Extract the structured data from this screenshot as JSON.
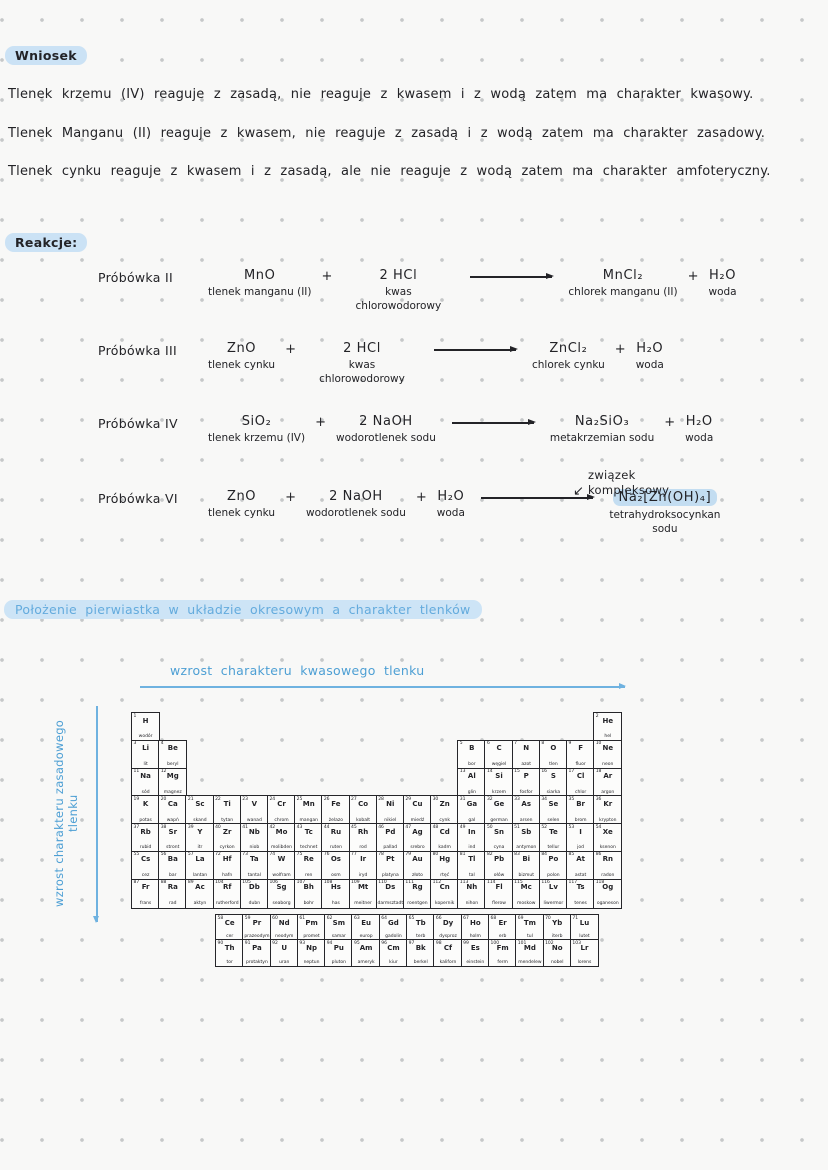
{
  "labels": {
    "wniosek": "Wniosek",
    "reakcje": "Reakcje:",
    "section_heading": "Położenie pierwiastka w układzie okresowym a charakter tlenków",
    "acid_arrow": "wzrost charakteru kwasowego tlenku",
    "base_arrow": "wzrost charakteru zasadowego tlenku",
    "complex_note_line1": "związek",
    "complex_note_line2": "kompleksowy"
  },
  "icons": {
    "complex_arrow": "↙"
  },
  "conclusions": [
    "Tlenek krzemu (IV) reaguje z zasadą, nie reaguje z kwasem i z wodą zatem ma charakter kwasowy.",
    "Tlenek Manganu (II) reaguje z kwasem, nie reaguje z zasadą i z wodą zatem ma charakter zasadowy.",
    "Tlenek cynku reaguje z kwasem i z zasadą, ale nie reaguje z wodą zatem ma charakter amfoteryczny."
  ],
  "reactions": [
    {
      "tube": "Próbówka II",
      "arrow_after": 2,
      "terms": [
        {
          "formula": "MnO",
          "label": "tlenek manganu (II)"
        },
        {
          "formula": "2 HCl",
          "label": "kwas chlorowodorowy"
        },
        {
          "formula": "MnCl₂",
          "label": "chlorek manganu (II)"
        },
        {
          "formula": "H₂O",
          "label": "woda"
        }
      ]
    },
    {
      "tube": "Próbówka III",
      "arrow_after": 2,
      "terms": [
        {
          "formula": "ZnO",
          "label": "tlenek cynku"
        },
        {
          "formula": "2 HCl",
          "label": "kwas chlorowodorowy"
        },
        {
          "formula": "ZnCl₂",
          "label": "chlorek cynku"
        },
        {
          "formula": "H₂O",
          "label": "woda"
        }
      ]
    },
    {
      "tube": "Próbówka IV",
      "arrow_after": 2,
      "terms": [
        {
          "formula": "SiO₂",
          "label": "tlenek krzemu (IV)"
        },
        {
          "formula": "2 NaOH",
          "label": "wodorotlenek sodu"
        },
        {
          "formula": "Na₂SiO₃",
          "label": "metakrzemian sodu"
        },
        {
          "formula": "H₂O",
          "label": "woda"
        }
      ]
    },
    {
      "tube": "Próbówka VI",
      "arrow_after": 3,
      "terms": [
        {
          "formula": "ZnO",
          "label": "tlenek cynku"
        },
        {
          "formula": "2 NaOH",
          "label": "wodorotlenek sodu"
        },
        {
          "formula": "H₂O",
          "label": "woda"
        },
        {
          "formula": "Na₂[Zn(OH)₄]",
          "label": "tetrahydroksocynkan sodu",
          "highlight": true
        }
      ]
    }
  ],
  "colors": {
    "ink": "#232327",
    "blue_ink": "#4d9fd4",
    "label_highlight": "#cbe2f5",
    "heading_highlight": "#cde4f6",
    "product_highlight": "#c3ddf1",
    "arrow_blue": "#6fb2e0",
    "dot_grid": "#c6c8c9",
    "paper": "#f8f8f7"
  },
  "periodic_table": {
    "elements": [
      [
        1,
        "H",
        "wodór",
        1,
        1
      ],
      [
        2,
        "He",
        "hel",
        1,
        18
      ],
      [
        3,
        "Li",
        "lit",
        2,
        1
      ],
      [
        4,
        "Be",
        "beryl",
        2,
        2
      ],
      [
        5,
        "B",
        "bor",
        2,
        13
      ],
      [
        6,
        "C",
        "węgiel",
        2,
        14
      ],
      [
        7,
        "N",
        "azot",
        2,
        15
      ],
      [
        8,
        "O",
        "tlen",
        2,
        16
      ],
      [
        9,
        "F",
        "fluor",
        2,
        17
      ],
      [
        10,
        "Ne",
        "neon",
        2,
        18
      ],
      [
        11,
        "Na",
        "sód",
        3,
        1
      ],
      [
        12,
        "Mg",
        "magnez",
        3,
        2
      ],
      [
        13,
        "Al",
        "glin",
        3,
        13
      ],
      [
        14,
        "Si",
        "krzem",
        3,
        14
      ],
      [
        15,
        "P",
        "fosfor",
        3,
        15
      ],
      [
        16,
        "S",
        "siarka",
        3,
        16
      ],
      [
        17,
        "Cl",
        "chlor",
        3,
        17
      ],
      [
        18,
        "Ar",
        "argon",
        3,
        18
      ],
      [
        19,
        "K",
        "potas",
        4,
        1
      ],
      [
        20,
        "Ca",
        "wapń",
        4,
        2
      ],
      [
        21,
        "Sc",
        "skand",
        4,
        3
      ],
      [
        22,
        "Ti",
        "tytan",
        4,
        4
      ],
      [
        23,
        "V",
        "wanad",
        4,
        5
      ],
      [
        24,
        "Cr",
        "chrom",
        4,
        6
      ],
      [
        25,
        "Mn",
        "mangan",
        4,
        7
      ],
      [
        26,
        "Fe",
        "żelazo",
        4,
        8
      ],
      [
        27,
        "Co",
        "kobalt",
        4,
        9
      ],
      [
        28,
        "Ni",
        "nikiel",
        4,
        10
      ],
      [
        29,
        "Cu",
        "miedź",
        4,
        11
      ],
      [
        30,
        "Zn",
        "cynk",
        4,
        12
      ],
      [
        31,
        "Ga",
        "gal",
        4,
        13
      ],
      [
        32,
        "Ge",
        "german",
        4,
        14
      ],
      [
        33,
        "As",
        "arsen",
        4,
        15
      ],
      [
        34,
        "Se",
        "selen",
        4,
        16
      ],
      [
        35,
        "Br",
        "brom",
        4,
        17
      ],
      [
        36,
        "Kr",
        "krypton",
        4,
        18
      ],
      [
        37,
        "Rb",
        "rubid",
        5,
        1
      ],
      [
        38,
        "Sr",
        "stront",
        5,
        2
      ],
      [
        39,
        "Y",
        "itr",
        5,
        3
      ],
      [
        40,
        "Zr",
        "cyrkon",
        5,
        4
      ],
      [
        41,
        "Nb",
        "niob",
        5,
        5
      ],
      [
        42,
        "Mo",
        "molibden",
        5,
        6
      ],
      [
        43,
        "Tc",
        "technet",
        5,
        7
      ],
      [
        44,
        "Ru",
        "ruten",
        5,
        8
      ],
      [
        45,
        "Rh",
        "rod",
        5,
        9
      ],
      [
        46,
        "Pd",
        "pallad",
        5,
        10
      ],
      [
        47,
        "Ag",
        "srebro",
        5,
        11
      ],
      [
        48,
        "Cd",
        "kadm",
        5,
        12
      ],
      [
        49,
        "In",
        "ind",
        5,
        13
      ],
      [
        50,
        "Sn",
        "cyna",
        5,
        14
      ],
      [
        51,
        "Sb",
        "antymon",
        5,
        15
      ],
      [
        52,
        "Te",
        "tellur",
        5,
        16
      ],
      [
        53,
        "I",
        "jod",
        5,
        17
      ],
      [
        54,
        "Xe",
        "ksenon",
        5,
        18
      ],
      [
        55,
        "Cs",
        "cez",
        6,
        1
      ],
      [
        56,
        "Ba",
        "bar",
        6,
        2
      ],
      [
        57,
        "La",
        "lantan",
        6,
        3
      ],
      [
        72,
        "Hf",
        "hafn",
        6,
        4
      ],
      [
        73,
        "Ta",
        "tantal",
        6,
        5
      ],
      [
        74,
        "W",
        "wolfram",
        6,
        6
      ],
      [
        75,
        "Re",
        "ren",
        6,
        7
      ],
      [
        76,
        "Os",
        "osm",
        6,
        8
      ],
      [
        77,
        "Ir",
        "iryd",
        6,
        9
      ],
      [
        78,
        "Pt",
        "platyna",
        6,
        10
      ],
      [
        79,
        "Au",
        "złoto",
        6,
        11
      ],
      [
        80,
        "Hg",
        "rtęć",
        6,
        12
      ],
      [
        81,
        "Tl",
        "tal",
        6,
        13
      ],
      [
        82,
        "Pb",
        "ołów",
        6,
        14
      ],
      [
        83,
        "Bi",
        "bizmut",
        6,
        15
      ],
      [
        84,
        "Po",
        "polon",
        6,
        16
      ],
      [
        85,
        "At",
        "astat",
        6,
        17
      ],
      [
        86,
        "Rn",
        "radon",
        6,
        18
      ],
      [
        87,
        "Fr",
        "frans",
        7,
        1
      ],
      [
        88,
        "Ra",
        "rad",
        7,
        2
      ],
      [
        89,
        "Ac",
        "aktyn",
        7,
        3
      ],
      [
        104,
        "Rf",
        "rutherford",
        7,
        4
      ],
      [
        105,
        "Db",
        "dubn",
        7,
        5
      ],
      [
        106,
        "Sg",
        "seaborg",
        7,
        6
      ],
      [
        107,
        "Bh",
        "bohr",
        7,
        7
      ],
      [
        108,
        "Hs",
        "has",
        7,
        8
      ],
      [
        109,
        "Mt",
        "meitner",
        7,
        9
      ],
      [
        110,
        "Ds",
        "darmsztadt",
        7,
        10
      ],
      [
        111,
        "Rg",
        "roentgen",
        7,
        11
      ],
      [
        112,
        "Cn",
        "kopernik",
        7,
        12
      ],
      [
        113,
        "Nh",
        "nihon",
        7,
        13
      ],
      [
        114,
        "Fl",
        "flerow",
        7,
        14
      ],
      [
        115,
        "Mc",
        "moskow",
        7,
        15
      ],
      [
        116,
        "Lv",
        "liwermor",
        7,
        16
      ],
      [
        117,
        "Ts",
        "tenes",
        7,
        17
      ],
      [
        118,
        "Og",
        "oganeson",
        7,
        18
      ]
    ],
    "lanthanides": [
      [
        58,
        "Ce",
        "cer"
      ],
      [
        59,
        "Pr",
        "prazeodym"
      ],
      [
        60,
        "Nd",
        "neodym"
      ],
      [
        61,
        "Pm",
        "promet"
      ],
      [
        62,
        "Sm",
        "samar"
      ],
      [
        63,
        "Eu",
        "europ"
      ],
      [
        64,
        "Gd",
        "gadolin"
      ],
      [
        65,
        "Tb",
        "terb"
      ],
      [
        66,
        "Dy",
        "dysproz"
      ],
      [
        67,
        "Ho",
        "holm"
      ],
      [
        68,
        "Er",
        "erb"
      ],
      [
        69,
        "Tm",
        "tul"
      ],
      [
        70,
        "Yb",
        "iterb"
      ],
      [
        71,
        "Lu",
        "lutet"
      ]
    ],
    "actinides": [
      [
        90,
        "Th",
        "tor"
      ],
      [
        91,
        "Pa",
        "protaktyn"
      ],
      [
        92,
        "U",
        "uran"
      ],
      [
        93,
        "Np",
        "neptun"
      ],
      [
        94,
        "Pu",
        "pluton"
      ],
      [
        95,
        "Am",
        "ameryk"
      ],
      [
        96,
        "Cm",
        "kiur"
      ],
      [
        97,
        "Bk",
        "berkel"
      ],
      [
        98,
        "Cf",
        "kaliforn"
      ],
      [
        99,
        "Es",
        "einstein"
      ],
      [
        100,
        "Fm",
        "ferm"
      ],
      [
        101,
        "Md",
        "mendelew"
      ],
      [
        102,
        "No",
        "nobel"
      ],
      [
        103,
        "Lr",
        "lorens"
      ]
    ]
  }
}
